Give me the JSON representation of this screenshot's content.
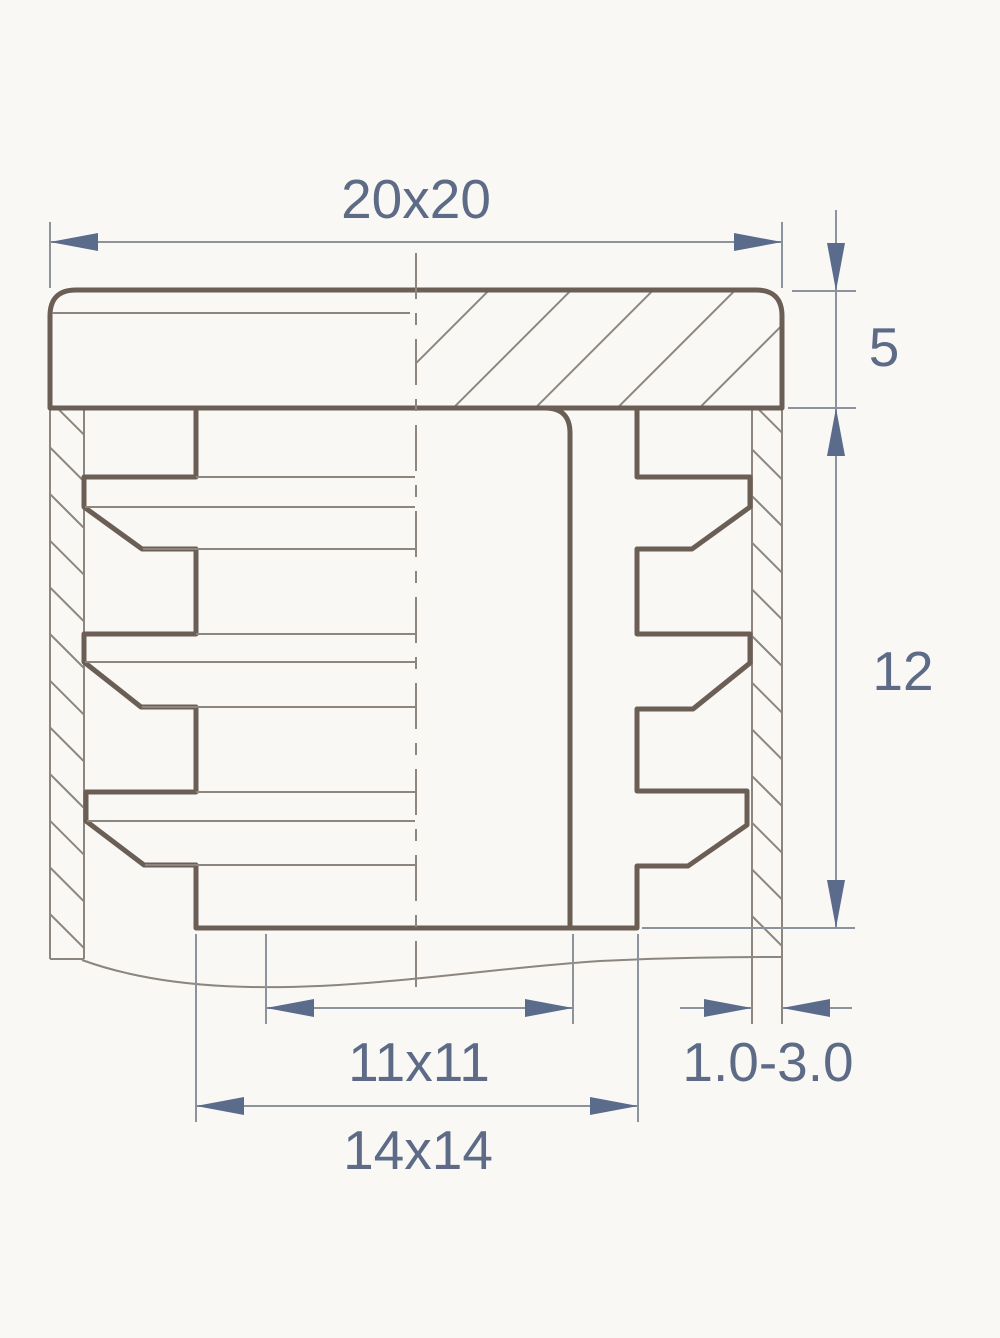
{
  "drawing": {
    "type": "technical-cross-section",
    "subject": "square tube insert plug",
    "dimensions": {
      "outer_cap": "20x20",
      "cap_height": "5",
      "insertion_depth": "12",
      "inner_cavity": "11x11",
      "insert_body": "14x14",
      "tube_wall_thickness": "1.0-3.0"
    },
    "colors": {
      "background": "#f9f8f5",
      "outline_thick": "#6b5e55",
      "outline_thin": "#8c867e",
      "dimension_lines": "#8d939d",
      "dimension_text": "#5d6b86",
      "arrowheads": "#5b6b8c"
    }
  }
}
